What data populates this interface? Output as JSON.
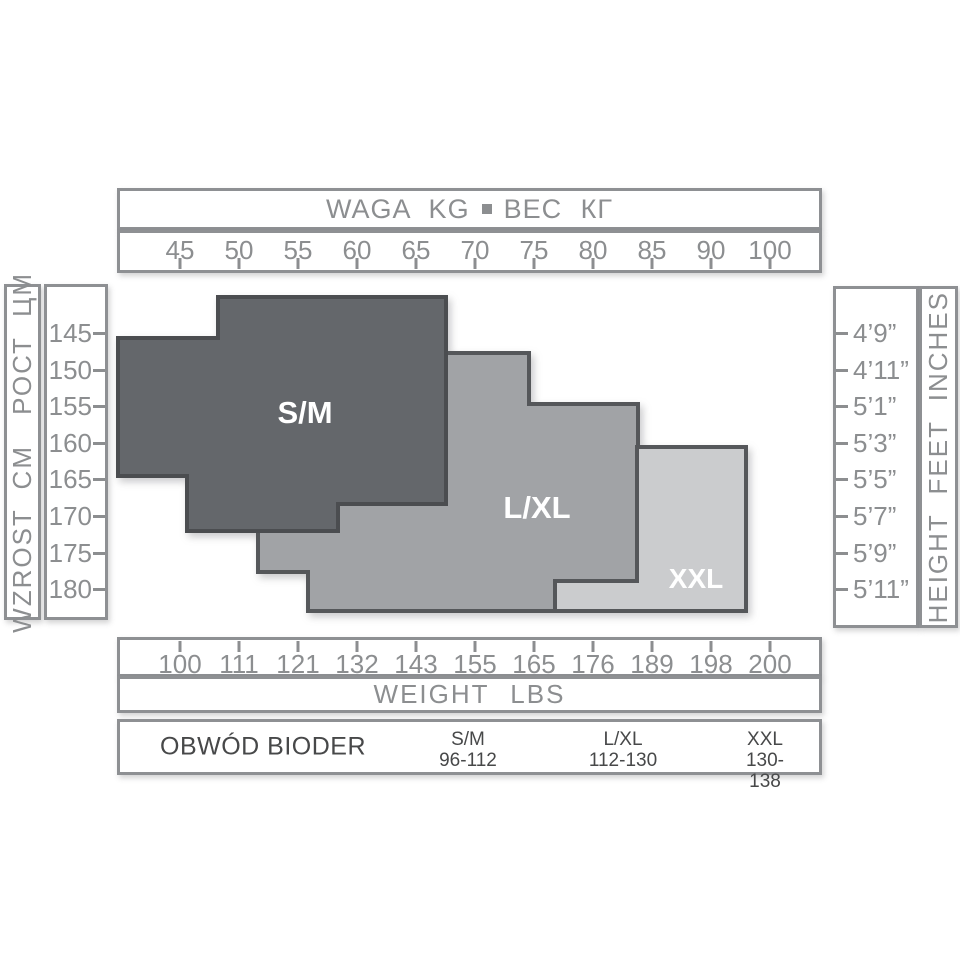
{
  "top_axis": {
    "title_left": "WAGA KG",
    "title_right": "ВЕС КГ",
    "ticks": [
      "45",
      "50",
      "55",
      "60",
      "65",
      "70",
      "75",
      "80",
      "85",
      "90",
      "100"
    ]
  },
  "bottom_axis": {
    "title": "WEIGHT LBS",
    "ticks": [
      "100",
      "111",
      "121",
      "132",
      "143",
      "155",
      "165",
      "176",
      "189",
      "198",
      "200"
    ]
  },
  "left_axis": {
    "label_pl": "WZROST CM",
    "label_ru": "РОСТ ЦМ",
    "ticks": [
      "145",
      "150",
      "155",
      "160",
      "165",
      "170",
      "175",
      "180"
    ]
  },
  "right_axis": {
    "label": "HEIGHT FEET INCHES",
    "ticks": [
      "4’9”",
      "4’11”",
      "5’1”",
      "5’3”",
      "5’5”",
      "5’7”",
      "5’9”",
      "5’11”"
    ]
  },
  "size_table": {
    "row_label": "OBWÓD BIODER",
    "entries": [
      {
        "size": "S/M",
        "range": "96-112"
      },
      {
        "size": "L/XL",
        "range": "112-130"
      },
      {
        "size": "XXL",
        "range": "130-138"
      }
    ]
  },
  "colors": {
    "box_border": "#8E9093",
    "axis_text": "#8C8E90",
    "table_text": "#474849",
    "sm_fill": "#64676B",
    "sm_stroke": "#4B4D50",
    "lxl_fill": "#A1A3A6",
    "lxl_stroke": "#55575A",
    "xxl_fill": "#CBCCCE",
    "xxl_stroke": "#55575A",
    "region_label": "#FFFFFF"
  },
  "chart_data": {
    "type": "area",
    "title": "Size chart: weight (kg / lbs) vs height (cm / feet-inches)",
    "x_axis_top": {
      "label": "WAGA KG ВЕС КГ",
      "ticks_kg": [
        45,
        50,
        55,
        60,
        65,
        70,
        75,
        80,
        85,
        90,
        100
      ]
    },
    "x_axis_bottom": {
      "label": "WEIGHT LBS",
      "ticks_lbs": [
        100,
        111,
        121,
        132,
        143,
        155,
        165,
        176,
        189,
        198,
        200
      ]
    },
    "y_axis_left": {
      "label": "WZROST CM РОСТ ЦМ",
      "ticks_cm": [
        145,
        150,
        155,
        160,
        165,
        170,
        175,
        180
      ]
    },
    "y_axis_right": {
      "label": "HEIGHT FEET INCHES",
      "ticks_ft": [
        "4’9”",
        "4’11”",
        "5’1”",
        "5’3”",
        "5’5”",
        "5’7”",
        "5’9”",
        "5’11”"
      ]
    },
    "regions": [
      {
        "name": "L/XL",
        "weight_kg_range": [
          52,
          84
        ],
        "height_cm_range": [
          148,
          184
        ],
        "hip_cm_range": "112-130",
        "fill": "#A1A3A6",
        "stroke": "#55575A",
        "polygon_px": [
          [
            446,
            353
          ],
          [
            529,
            353
          ],
          [
            529,
            404
          ],
          [
            638,
            404
          ],
          [
            638,
            611
          ],
          [
            308,
            611
          ],
          [
            308,
            572
          ],
          [
            258,
            572
          ],
          [
            258,
            445
          ],
          [
            446,
            445
          ]
        ],
        "label_px": [
          537,
          518
        ],
        "label_size": 31
      },
      {
        "name": "XXL",
        "weight_kg_range": [
          77,
          93
        ],
        "height_cm_range": [
          161,
          184
        ],
        "hip_cm_range": "130-138",
        "fill": "#CBCCCE",
        "stroke": "#55575A",
        "polygon_px": [
          [
            637,
            447
          ],
          [
            746,
            447
          ],
          [
            746,
            611
          ],
          [
            555,
            611
          ],
          [
            555,
            581
          ],
          [
            637,
            581
          ]
        ],
        "label_px": [
          696,
          588
        ],
        "label_size": 28
      },
      {
        "name": "S/M",
        "weight_kg_range": [
          40,
          68
        ],
        "height_cm_range": [
          140,
          173
        ],
        "hip_cm_range": "96-112",
        "fill": "#64676B",
        "stroke": "#4B4D50",
        "polygon_px": [
          [
            218,
            297
          ],
          [
            446,
            297
          ],
          [
            446,
            504
          ],
          [
            338,
            504
          ],
          [
            338,
            531
          ],
          [
            187,
            531
          ],
          [
            187,
            476
          ],
          [
            118,
            476
          ],
          [
            118,
            338
          ],
          [
            218,
            338
          ]
        ],
        "label_px": [
          305,
          423
        ],
        "label_size": 31
      }
    ]
  }
}
